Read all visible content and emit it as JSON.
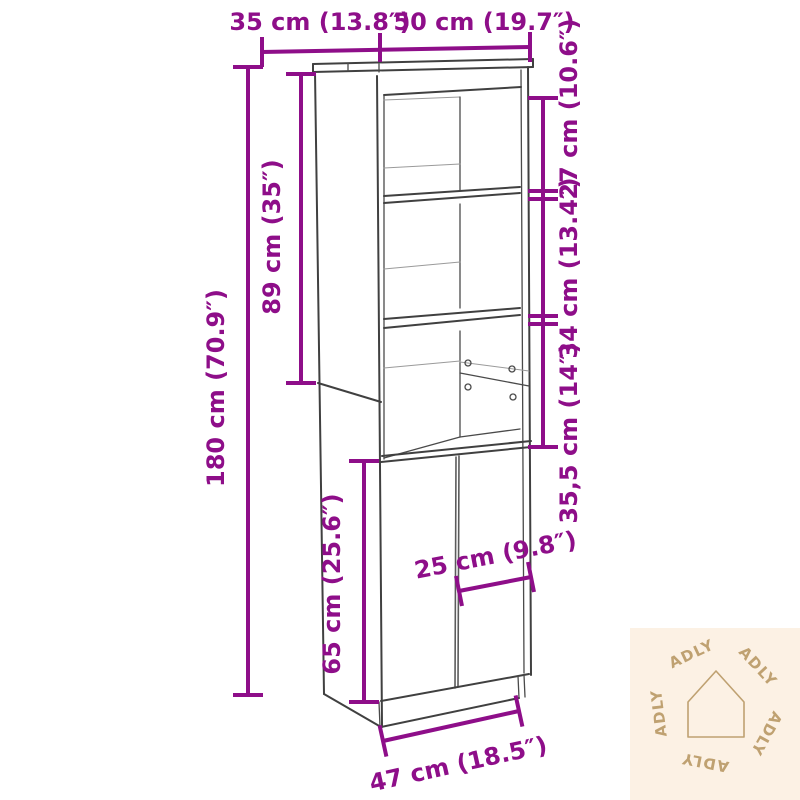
{
  "diagram": {
    "type": "furniture-dimension-diagram",
    "subject": "tall highboard cabinet with open shelves and two doors",
    "accent_color": "#8e0e89",
    "line_color": "#404040",
    "background_color": "#ffffff"
  },
  "dimensions": {
    "top_depth": "35 cm (13.8″)",
    "top_width": "50 cm (19.7″)",
    "right_upper_shelf": "27 cm (10.6″)",
    "right_middle_shelf": "34 cm (13.4″)",
    "right_lower_shelf": "35,5 cm (14″)",
    "total_height": "180 cm (70.9″)",
    "upper_section_height": "89 cm (35″)",
    "door_section_height": "65 cm (25.6″)",
    "inner_door_width": "25 cm (9.8″)",
    "bottom_width": "47 cm (18.5″)"
  },
  "watermark": {
    "brand": "ADLY",
    "repeat_count": 5,
    "bg_color": "#fcf1e4",
    "fg_color": "#bfa171",
    "icon": "house-outline"
  }
}
